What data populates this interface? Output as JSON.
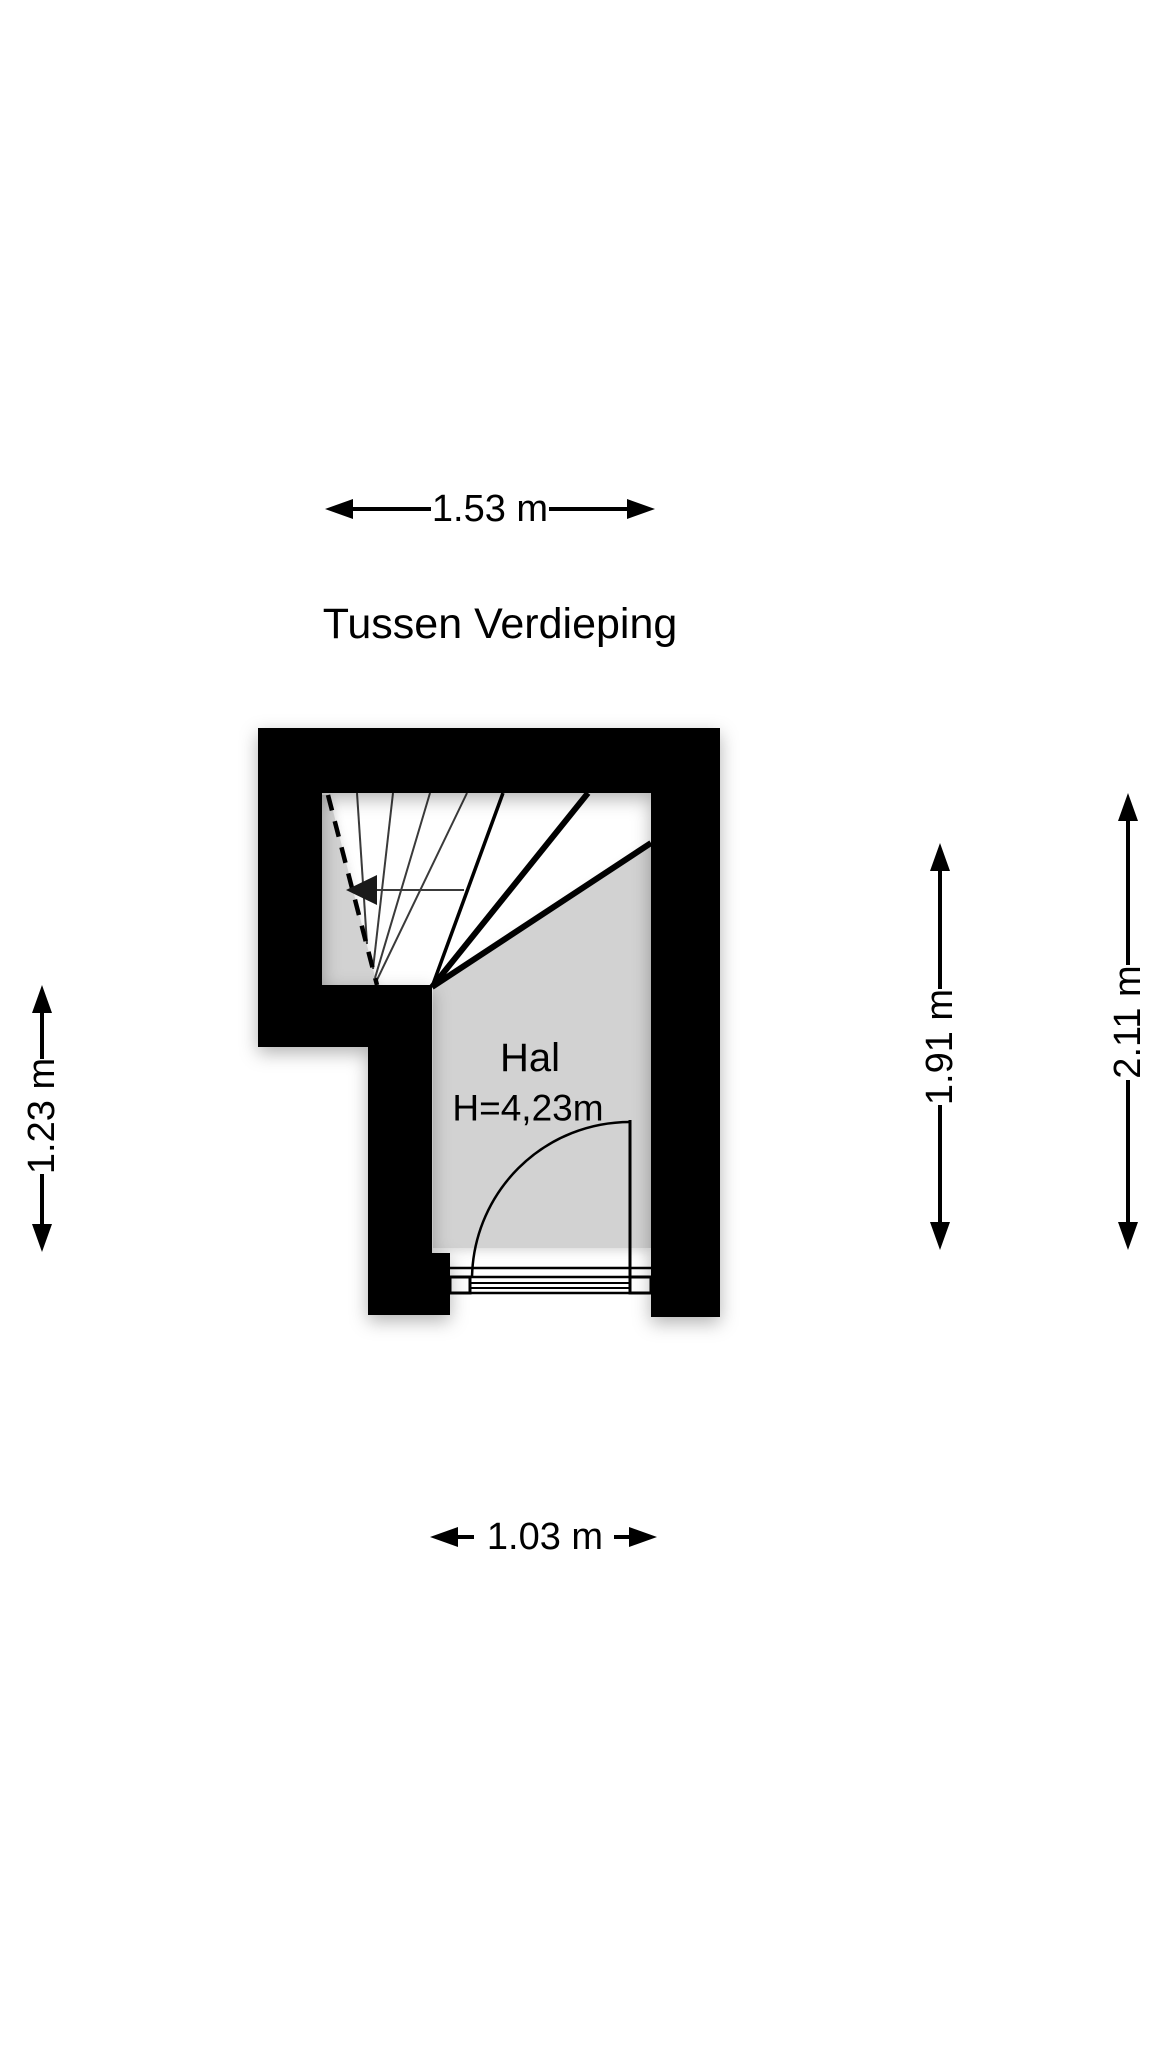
{
  "title": "Tussen Verdieping",
  "floor_plan": {
    "room": {
      "name": "Hal",
      "ceiling_height": "H=4,23m"
    },
    "colors": {
      "wall": "#000000",
      "floor": "#d2d2d2",
      "line": "#000000",
      "tread_line": "#3a3a3a",
      "background": "#ffffff"
    },
    "stair_direction_icon": "left-arrow",
    "door": "quarter-circle-swing-bottom-right"
  },
  "dimensions": {
    "top": {
      "label": "1.53 m"
    },
    "left": {
      "label": "1.23 m"
    },
    "right_inner": {
      "label": "1.91 m"
    },
    "right_outer": {
      "label": "2.11 m"
    },
    "bottom": {
      "label": "1.03 m"
    }
  }
}
